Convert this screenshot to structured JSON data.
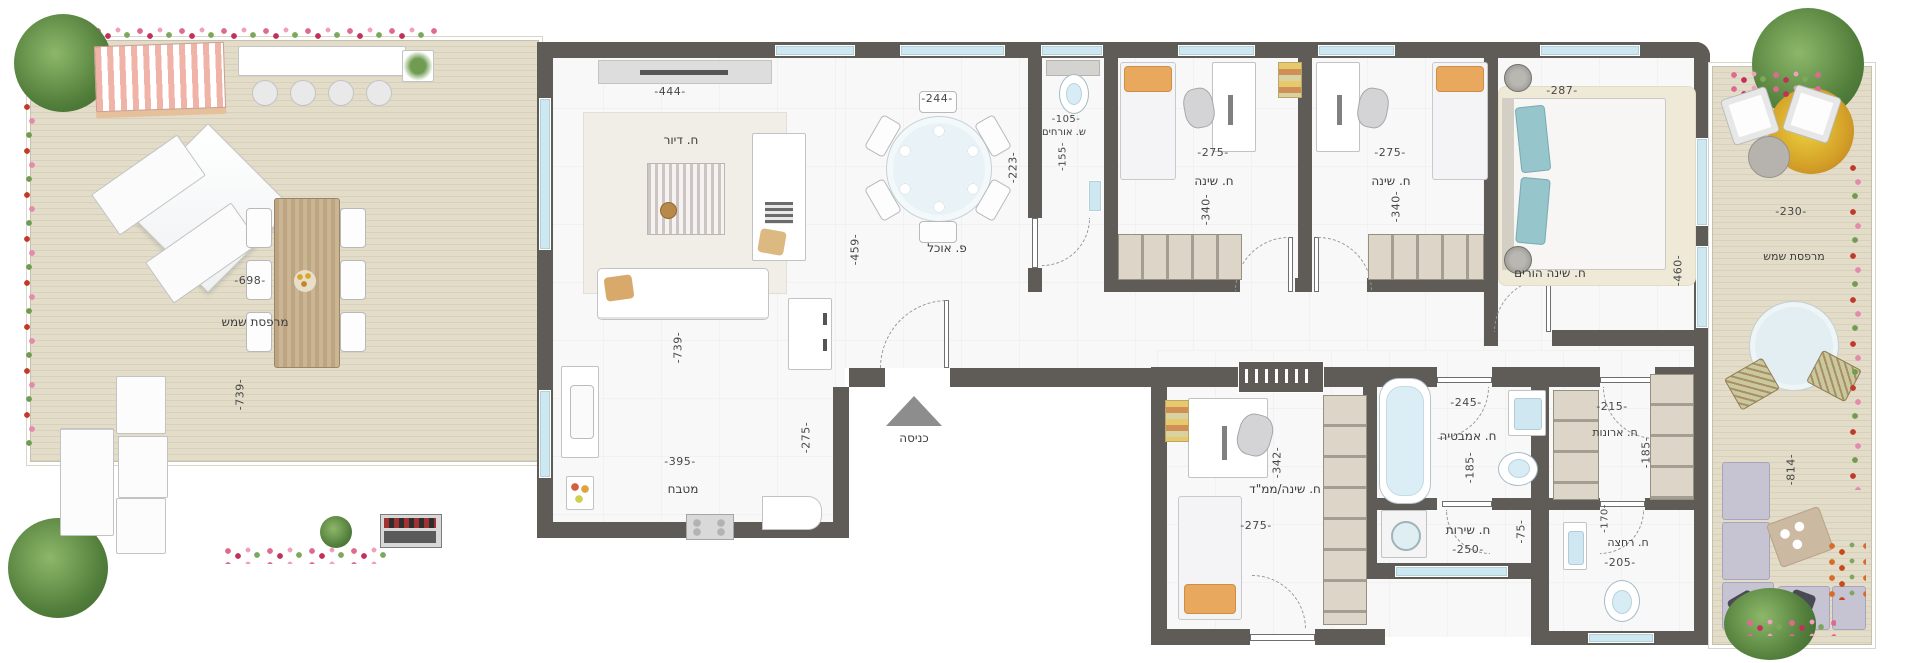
{
  "meta": {
    "type": "apartment-floor-plan",
    "language": "hebrew"
  },
  "colors": {
    "wall": "#5f5b57",
    "deck": "#ded7c3",
    "interior_floor": "#f8f8f9",
    "window_glass": "#cde8f1",
    "label_text": "#3c3c3c",
    "pillow_orange": "#e8a95e",
    "pillow_teal": "#96c5cb",
    "flower_pink": "#df6a8f"
  },
  "rooms": {
    "terrace_left": {
      "label": "מרפסת שמש",
      "dims": {
        "width": "-698-",
        "height": "-739-"
      }
    },
    "living": {
      "label": "ח. דיור",
      "dims": {
        "top": "-444-",
        "height": "-739-"
      }
    },
    "kitchen": {
      "label": "מטבח",
      "dims": {
        "width": "-395-",
        "right": "-275-"
      }
    },
    "dining": {
      "label": "פ. אוכל",
      "dims": {
        "top": "-244-",
        "right": "-223-",
        "left": "-459-"
      }
    },
    "entrance": {
      "label": "כניסה"
    },
    "guest_wc": {
      "label": "ש. אורחים",
      "dims": {
        "width": "-105-",
        "height": "-155-"
      }
    },
    "bedroom1": {
      "label": "ח. שינה",
      "dims": {
        "width": "-275-",
        "height": "-340-"
      }
    },
    "bedroom2": {
      "label": "ח. שינה",
      "dims": {
        "width": "-275-",
        "height": "-340-"
      }
    },
    "master_bedroom": {
      "label": "ח. שינה הורים",
      "dims": {
        "top": "-287-",
        "right": "-460-"
      }
    },
    "terrace_right": {
      "label": "מרפסת שמש",
      "dims": {
        "width": "-230-",
        "height": "-814-"
      }
    },
    "mamad_bedroom": {
      "label": "ח. שינה/ממ\"ד",
      "dims": {
        "height": "-342-",
        "width": "-275-"
      }
    },
    "bathroom": {
      "label": "ח. אמבטיה",
      "dims": {
        "width": "-245-",
        "height": "-185-"
      }
    },
    "service": {
      "label": "ח. שירות",
      "dims": {
        "width": "-250-",
        "height": "-75-"
      }
    },
    "wardrobe": {
      "label": "ח. ארונות",
      "dims": {
        "width": "-215-",
        "height": "-185-"
      }
    },
    "shower": {
      "label": "ח. רחצה",
      "dims": {
        "width": "-205-",
        "height": "-170-"
      }
    }
  }
}
